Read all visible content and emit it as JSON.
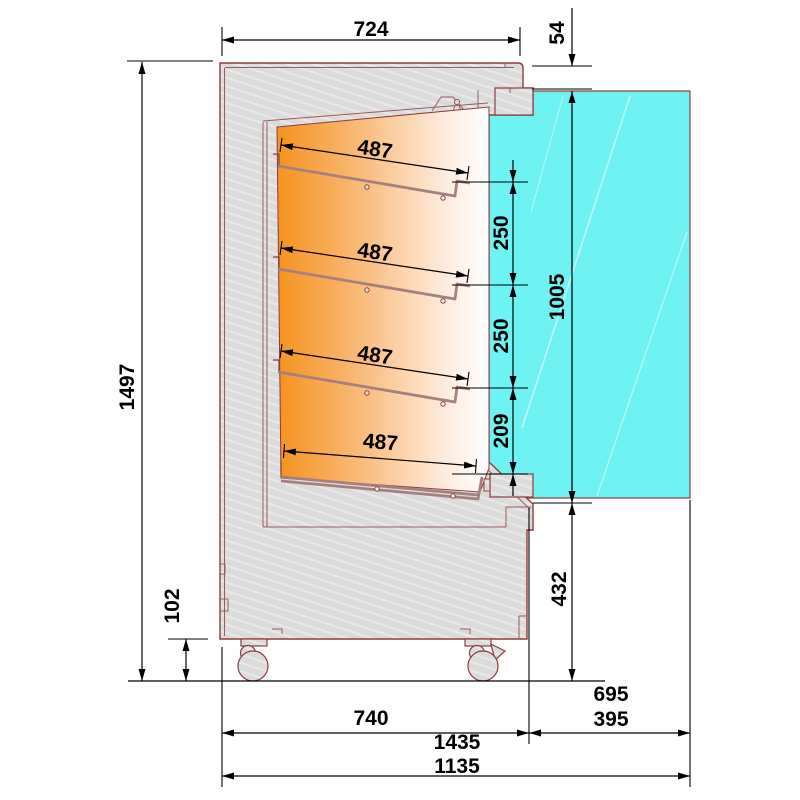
{
  "drawing": {
    "type": "refrigerated-display-case-cross-section",
    "colors": {
      "outline": "#8e3c3c",
      "body_fill": "#dbdbdb",
      "door_fill": "#6ef2f2",
      "interior_gradient_start": "#f5921e",
      "interior_gradient_end": "#ffffff",
      "dimension_color": "#000000"
    },
    "dims": {
      "top_width": "724",
      "top_offset": "54",
      "total_height": "1497",
      "shelf_depths": [
        "487",
        "487",
        "487",
        "487"
      ],
      "shelf_spacings": [
        "250",
        "250",
        "209"
      ],
      "door_height": "1005",
      "below_door_height": "432",
      "caster_height": "102",
      "base_depth": "740",
      "front_ext_open": "695",
      "front_ext": "395",
      "total_depth_open": "1435",
      "total_depth": "1135"
    }
  }
}
